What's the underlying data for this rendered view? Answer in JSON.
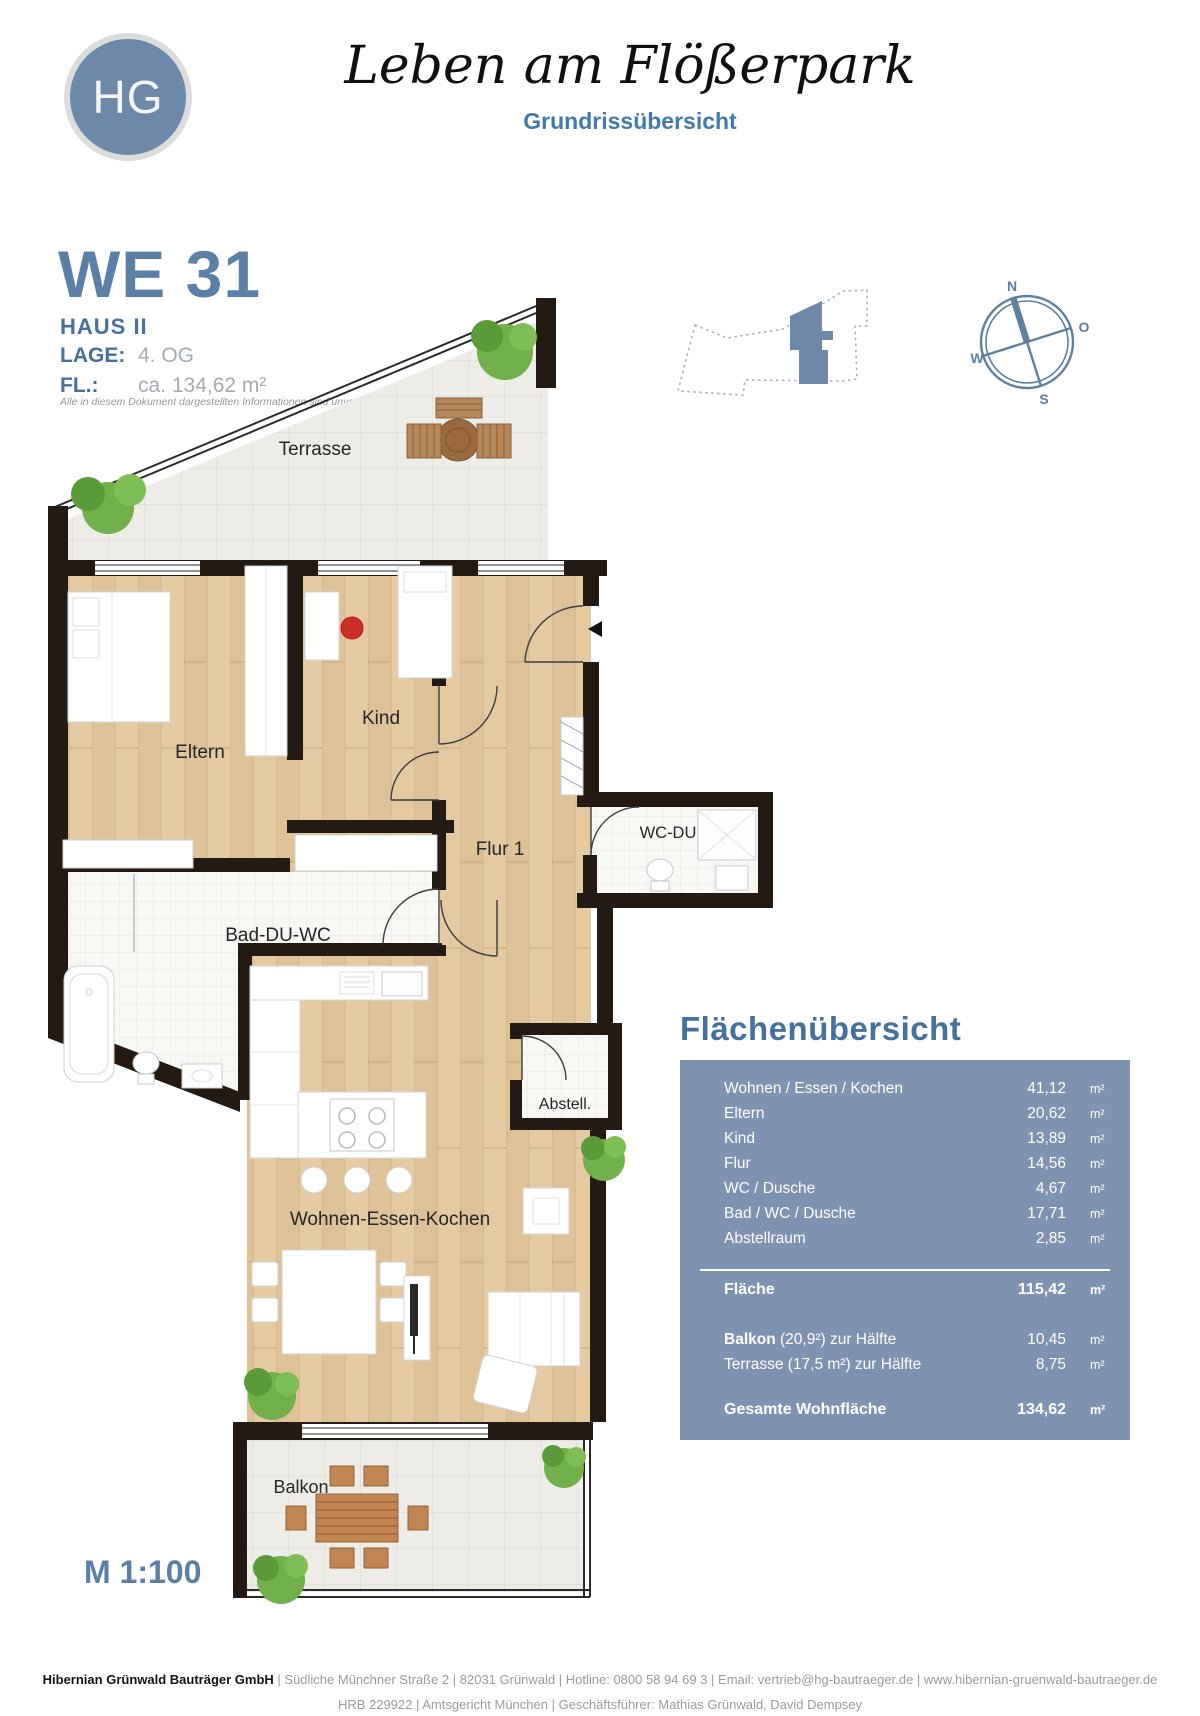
{
  "header": {
    "logo": "HG",
    "title": "Leben am Flößerpark",
    "subtitle": "Grundrissübersicht"
  },
  "unit": {
    "id": "WE 31",
    "haus": "HAUS II",
    "lage_label": "LAGE:",
    "lage_value": "4. OG",
    "fl_label": "FL.:",
    "fl_value": "ca. 134,62 m²",
    "disclaimer": "Alle in diesem Dokument dargestellten Informationen sind unverbindlich."
  },
  "compass": {
    "n": "N",
    "o": "O",
    "s": "S",
    "w": "W"
  },
  "plan": {
    "scale": "M 1:100",
    "rooms": {
      "terrasse": "Terrasse",
      "eltern": "Eltern",
      "kind": "Kind",
      "flur1": "Flur 1",
      "wcdu": "WC-DU",
      "bad": "Bad-DU-WC",
      "abstell": "Abstell.",
      "wohnen": "Wohnen-Essen-Kochen",
      "balkon": "Balkon"
    }
  },
  "area_table": {
    "heading": "Flächenübersicht",
    "unit": "m²",
    "rows": [
      {
        "label": "Wohnen / Essen / Kochen",
        "value": "41,12"
      },
      {
        "label": "Eltern",
        "value": "20,62"
      },
      {
        "label": "Kind",
        "value": "13,89"
      },
      {
        "label": "Flur",
        "value": "14,56"
      },
      {
        "label": "WC / Dusche",
        "value": "4,67"
      },
      {
        "label": "Bad / WC / Dusche",
        "value": "17,71"
      },
      {
        "label": "Abstellraum",
        "value": "2,85"
      }
    ],
    "subtotal": {
      "label": "Fläche",
      "value": "115,42"
    },
    "half_rows": [
      {
        "bold": "Balkon",
        "rest": " (20,9²) zur Hälfte",
        "value": "10,45"
      },
      {
        "bold": "",
        "rest": "Terrasse (17,5 m²) zur Hälfte",
        "value": "8,75"
      }
    ],
    "total": {
      "label": "Gesamte Wohnfläche",
      "value": "134,62"
    }
  },
  "footer": {
    "line1_bold": "Hibernian Grünwald Bauträger GmbH",
    "line1_rest": " | Südliche Münchner Straße 2 | 82031 Grünwald | Hotline: 0800 58 94 69 3 | Email: vertrieb@hg-bautraeger.de | www.hibernian-gruenwald-bautraeger.de",
    "line2": "HRB 229922 | Amtsgericht München | Geschäftsführer: Mathias Grünwald, David Dempsey"
  },
  "colors": {
    "accent": "#5b80a8",
    "panel": "#7e93b1",
    "wall": "#231b13",
    "wood": "#e3c79f",
    "tile": "#f6f6f4"
  }
}
